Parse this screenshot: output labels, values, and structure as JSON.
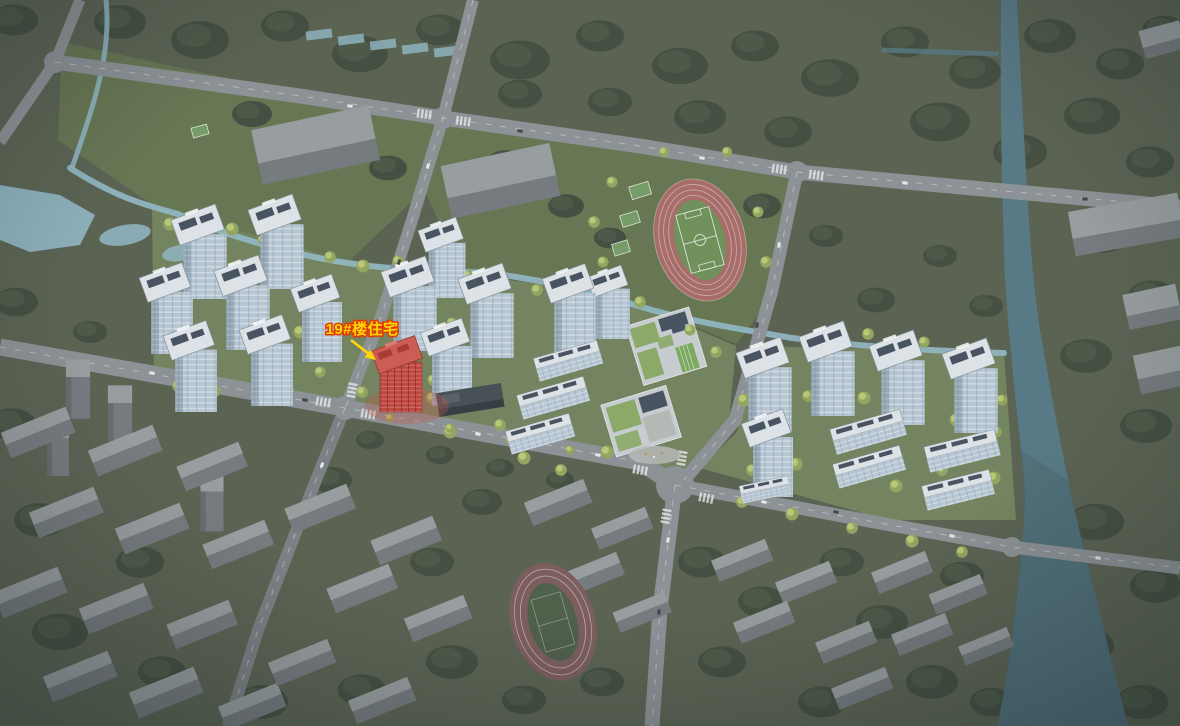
{
  "scene": {
    "annotation": {
      "label": "19#楼住宅",
      "target": "building-19-residential"
    }
  },
  "colors": {
    "ground-context": "#59624f",
    "ground-park": "#66744f",
    "ground-site": "#75835c",
    "forest": "#4c5744",
    "forest-dark": "#424d3d",
    "tree-bright": "#bcca74",
    "tree-mid": "#93a75e",
    "water-light": "#93bac8",
    "water-canal": "#567984",
    "water-river": "#47616b",
    "road-bright": "#8d9294",
    "road-minor": "#7b8082",
    "road-line": "#dadedf",
    "ctx-roof": "#999e9f",
    "ctx-side": "#757a7c",
    "bldg-roof": "#e0e5e9",
    "bldg-face": "#b9c8d4",
    "solar": "#46515d",
    "school-gray": "#c9ced1",
    "school-green": "#8cab67",
    "plaza": "#b7bab6",
    "court-green": "#759c66",
    "track-red": "#aa6a66",
    "track-line": "#d8c8c6",
    "field-green": "#6f9157",
    "field-line": "#dfe8d8",
    "track2-red": "#7d5b5a",
    "field2-green": "#4d5e47",
    "highlight-face": "#c2453d",
    "highlight-roof": "#d05a50",
    "highlight-dark": "#8e2d28",
    "highlight-glow": "#c94f43",
    "label-yellow": "#ffd60a",
    "label-outline": "#e03c00",
    "car-white": "#e9ebec",
    "car-dark": "#3e4449"
  }
}
